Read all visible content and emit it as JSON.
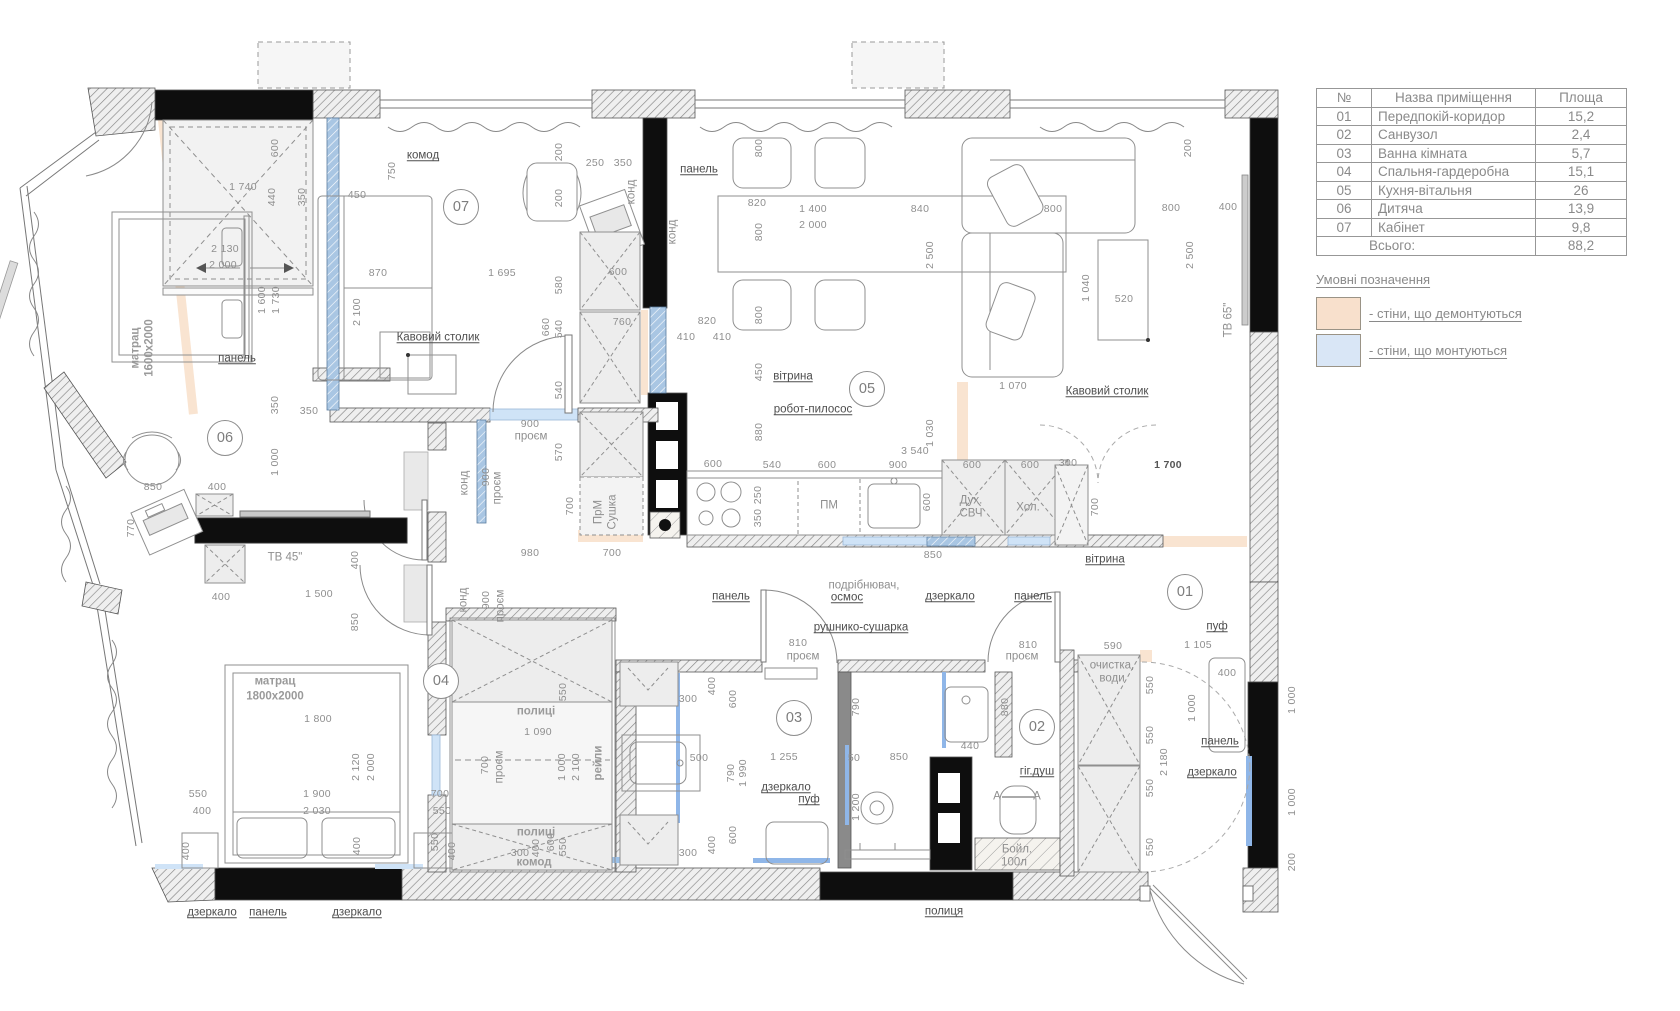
{
  "table": {
    "headers": [
      "№",
      "Назва приміщення",
      "Площа"
    ],
    "rows": [
      [
        "01",
        "Передпокій-коридор",
        "15,2"
      ],
      [
        "02",
        "Санвузол",
        "2,4"
      ],
      [
        "03",
        "Ванна кімната",
        "5,7"
      ],
      [
        "04",
        "Спальня-гардеробна",
        "15,1"
      ],
      [
        "05",
        "Кухня-вітальня",
        "26"
      ],
      [
        "06",
        "Дитяча",
        "13,9"
      ],
      [
        "07",
        "Кабінет",
        "9,8"
      ]
    ],
    "total_label": "Всього:",
    "total_value": "88,2"
  },
  "legend": {
    "title": "Умовні позначення",
    "items": [
      {
        "color": "#f8e0cc",
        "label": "- стіни, що демонтуються"
      },
      {
        "color": "#d9e6f6",
        "label": "- стіни, що монтуються"
      }
    ]
  },
  "colors": {
    "demolish": "#f8dfc9",
    "mount_blue": "#aac7e4",
    "light_blue": "#cfe3f7"
  },
  "plan": {
    "rooms": [
      {
        "num": "01",
        "x": 1185,
        "y": 592
      },
      {
        "num": "02",
        "x": 1037,
        "y": 727
      },
      {
        "num": "03",
        "x": 794,
        "y": 718
      },
      {
        "num": "04",
        "x": 441,
        "y": 681
      },
      {
        "num": "05",
        "x": 867,
        "y": 389
      },
      {
        "num": "06",
        "x": 225,
        "y": 438
      },
      {
        "num": "07",
        "x": 461,
        "y": 207
      }
    ],
    "labels": [
      {
        "t": "комод",
        "x": 423,
        "y": 156,
        "u": 1
      },
      {
        "t": "панель",
        "x": 699,
        "y": 170,
        "u": 1
      },
      {
        "t": "Кавовий столик",
        "x": 438,
        "y": 338,
        "u": 1
      },
      {
        "t": "панель",
        "x": 237,
        "y": 359,
        "u": 1
      },
      {
        "t": "вітрина",
        "x": 793,
        "y": 377,
        "u": 1
      },
      {
        "t": "робот-пилосос",
        "x": 813,
        "y": 410,
        "u": 1
      },
      {
        "t": "Кавовий столик",
        "x": 1107,
        "y": 392,
        "u": 1
      },
      {
        "t": "панель",
        "x": 731,
        "y": 597,
        "u": 1
      },
      {
        "t": "подрібнювач,",
        "x": 864,
        "y": 586
      },
      {
        "t": "осмос",
        "x": 847,
        "y": 598,
        "u": 1
      },
      {
        "t": "дзеркало",
        "x": 950,
        "y": 597,
        "u": 1
      },
      {
        "t": "панель",
        "x": 1033,
        "y": 597,
        "u": 1
      },
      {
        "t": "рушнико-сушарка",
        "x": 861,
        "y": 628,
        "u": 1
      },
      {
        "t": "вітрина",
        "x": 1105,
        "y": 560,
        "u": 1
      },
      {
        "t": "дзеркало",
        "x": 786,
        "y": 788,
        "u": 1
      },
      {
        "t": "пуф",
        "x": 809,
        "y": 800,
        "u": 1
      },
      {
        "t": "гіг.душ",
        "x": 1037,
        "y": 772,
        "u": 1
      },
      {
        "t": "Бойл.",
        "x": 1017,
        "y": 850
      },
      {
        "t": "100л",
        "x": 1014,
        "y": 863
      },
      {
        "t": "полиця",
        "x": 944,
        "y": 912,
        "u": 1
      },
      {
        "t": "дзеркало",
        "x": 212,
        "y": 913,
        "u": 1
      },
      {
        "t": "панель",
        "x": 268,
        "y": 913,
        "u": 1
      },
      {
        "t": "дзеркало",
        "x": 357,
        "y": 913,
        "u": 1
      },
      {
        "t": "пуф",
        "x": 1217,
        "y": 627,
        "u": 1
      },
      {
        "t": "панель",
        "x": 1220,
        "y": 742,
        "u": 1
      },
      {
        "t": "дзеркало",
        "x": 1212,
        "y": 773,
        "u": 1
      },
      {
        "t": "очистка,",
        "x": 1112,
        "y": 666
      },
      {
        "t": "води",
        "x": 1112,
        "y": 679
      },
      {
        "t": "ПМ",
        "x": 829,
        "y": 506
      },
      {
        "t": "Дух.",
        "x": 971,
        "y": 501
      },
      {
        "t": "СВЧ",
        "x": 971,
        "y": 514
      },
      {
        "t": "Хол.",
        "x": 1028,
        "y": 508
      },
      {
        "t": "ПрМ",
        "x": 599,
        "y": 512,
        "r": 1
      },
      {
        "t": "Сушка",
        "x": 613,
        "y": 512,
        "r": 1
      },
      {
        "t": "конд",
        "x": 632,
        "y": 192,
        "r": 1
      },
      {
        "t": "конд",
        "x": 673,
        "y": 232,
        "r": 1
      },
      {
        "t": "конд",
        "x": 465,
        "y": 483,
        "r": 1
      },
      {
        "t": "конд",
        "x": 464,
        "y": 600,
        "r": 1
      },
      {
        "t": "проєм",
        "x": 498,
        "y": 488,
        "r": 1
      },
      {
        "t": "проєм",
        "x": 501,
        "y": 606,
        "r": 1
      },
      {
        "t": "проєм",
        "x": 531,
        "y": 437
      },
      {
        "t": "проєм",
        "x": 803,
        "y": 657
      },
      {
        "t": "проєм",
        "x": 1022,
        "y": 657
      },
      {
        "t": "проєм",
        "x": 500,
        "y": 767,
        "r": 1
      },
      {
        "t": "матрац",
        "x": 136,
        "y": 348,
        "r": 1,
        "b": 1
      },
      {
        "t": "1600х2000",
        "x": 150,
        "y": 348,
        "r": 1,
        "b": 1
      },
      {
        "t": "матрац",
        "x": 275,
        "y": 682,
        "b": 1
      },
      {
        "t": "1800х2000",
        "x": 275,
        "y": 697,
        "b": 1
      },
      {
        "t": "ТВ 45\"",
        "x": 285,
        "y": 558
      },
      {
        "t": "ТВ 65\"",
        "x": 1229,
        "y": 320,
        "r": 1
      },
      {
        "t": "полиці",
        "x": 536,
        "y": 712,
        "b": 1
      },
      {
        "t": "полиці",
        "x": 536,
        "y": 833,
        "b": 1
      },
      {
        "t": "комод",
        "x": 534,
        "y": 863,
        "b": 1
      },
      {
        "t": "рейли",
        "x": 599,
        "y": 763,
        "r": 1,
        "b": 1
      },
      {
        "t": "A",
        "x": 997,
        "y": 797
      },
      {
        "t": "A",
        "x": 1037,
        "y": 797
      }
    ],
    "dims": [
      {
        "t": "600",
        "x": 275,
        "y": 148,
        "r": 1
      },
      {
        "t": "1 740",
        "x": 243,
        "y": 187
      },
      {
        "t": "440",
        "x": 272,
        "y": 197,
        "r": 1
      },
      {
        "t": "350",
        "x": 302,
        "y": 197,
        "r": 1
      },
      {
        "t": "450",
        "x": 357,
        "y": 195
      },
      {
        "t": "750",
        "x": 392,
        "y": 171,
        "r": 1
      },
      {
        "t": "2 130",
        "x": 225,
        "y": 249
      },
      {
        "t": "2 000",
        "x": 223,
        "y": 265
      },
      {
        "t": "1 600",
        "x": 262,
        "y": 300,
        "r": 1
      },
      {
        "t": "1 730",
        "x": 276,
        "y": 300,
        "r": 1
      },
      {
        "t": "870",
        "x": 378,
        "y": 273
      },
      {
        "t": "2 100",
        "x": 357,
        "y": 312,
        "r": 1
      },
      {
        "t": "350",
        "x": 275,
        "y": 405,
        "r": 1
      },
      {
        "t": "350",
        "x": 309,
        "y": 411
      },
      {
        "t": "1 000",
        "x": 275,
        "y": 462,
        "r": 1
      },
      {
        "t": "850",
        "x": 153,
        "y": 487
      },
      {
        "t": "400",
        "x": 217,
        "y": 487
      },
      {
        "t": "770",
        "x": 131,
        "y": 528,
        "r": 1
      },
      {
        "t": "400",
        "x": 355,
        "y": 560,
        "r": 1
      },
      {
        "t": "400",
        "x": 221,
        "y": 597
      },
      {
        "t": "1 500",
        "x": 319,
        "y": 594
      },
      {
        "t": "200",
        "x": 559,
        "y": 152,
        "r": 1
      },
      {
        "t": "250",
        "x": 595,
        "y": 163
      },
      {
        "t": "350",
        "x": 623,
        "y": 163
      },
      {
        "t": "200",
        "x": 559,
        "y": 198,
        "r": 1
      },
      {
        "t": "820",
        "x": 757,
        "y": 203
      },
      {
        "t": "1 400",
        "x": 813,
        "y": 209
      },
      {
        "t": "2 000",
        "x": 813,
        "y": 225
      },
      {
        "t": "800",
        "x": 759,
        "y": 148,
        "r": 1
      },
      {
        "t": "800",
        "x": 759,
        "y": 232,
        "r": 1
      },
      {
        "t": "800",
        "x": 759,
        "y": 315,
        "r": 1
      },
      {
        "t": "1 695",
        "x": 502,
        "y": 273
      },
      {
        "t": "580",
        "x": 559,
        "y": 285,
        "r": 1
      },
      {
        "t": "600",
        "x": 618,
        "y": 272
      },
      {
        "t": "660",
        "x": 546,
        "y": 327,
        "r": 1
      },
      {
        "t": "540",
        "x": 559,
        "y": 329,
        "r": 1
      },
      {
        "t": "760",
        "x": 622,
        "y": 322
      },
      {
        "t": "820",
        "x": 707,
        "y": 321
      },
      {
        "t": "410",
        "x": 686,
        "y": 337
      },
      {
        "t": "410",
        "x": 722,
        "y": 337
      },
      {
        "t": "450",
        "x": 759,
        "y": 372,
        "r": 1
      },
      {
        "t": "900",
        "x": 530,
        "y": 424
      },
      {
        "t": "540",
        "x": 559,
        "y": 390,
        "r": 1
      },
      {
        "t": "570",
        "x": 559,
        "y": 452,
        "r": 1
      },
      {
        "t": "700",
        "x": 570,
        "y": 506,
        "r": 1
      },
      {
        "t": "840",
        "x": 920,
        "y": 209
      },
      {
        "t": "2 500",
        "x": 930,
        "y": 255,
        "r": 1
      },
      {
        "t": "800",
        "x": 1053,
        "y": 209
      },
      {
        "t": "800",
        "x": 1171,
        "y": 208
      },
      {
        "t": "400",
        "x": 1228,
        "y": 207
      },
      {
        "t": "200",
        "x": 1188,
        "y": 148,
        "r": 1
      },
      {
        "t": "2 500",
        "x": 1190,
        "y": 255,
        "r": 1
      },
      {
        "t": "1 040",
        "x": 1086,
        "y": 288,
        "r": 1
      },
      {
        "t": "520",
        "x": 1124,
        "y": 299
      },
      {
        "t": "1 070",
        "x": 1013,
        "y": 386
      },
      {
        "t": "1 030",
        "x": 930,
        "y": 433,
        "r": 1
      },
      {
        "t": "3 540",
        "x": 915,
        "y": 451
      },
      {
        "t": "1 700",
        "x": 1168,
        "y": 465,
        "dark": 1
      },
      {
        "t": "600",
        "x": 713,
        "y": 464
      },
      {
        "t": "880",
        "x": 759,
        "y": 432,
        "r": 1
      },
      {
        "t": "540",
        "x": 772,
        "y": 465
      },
      {
        "t": "600",
        "x": 827,
        "y": 465
      },
      {
        "t": "900",
        "x": 898,
        "y": 465
      },
      {
        "t": "600",
        "x": 972,
        "y": 465
      },
      {
        "t": "600",
        "x": 1030,
        "y": 465
      },
      {
        "t": "300",
        "x": 1068,
        "y": 463
      },
      {
        "t": "250",
        "x": 758,
        "y": 495,
        "r": 1
      },
      {
        "t": "350",
        "x": 758,
        "y": 518,
        "r": 1
      },
      {
        "t": "600",
        "x": 927,
        "y": 502,
        "r": 1
      },
      {
        "t": "700",
        "x": 1095,
        "y": 507,
        "r": 1
      },
      {
        "t": "700",
        "x": 612,
        "y": 553
      },
      {
        "t": "980",
        "x": 530,
        "y": 553
      },
      {
        "t": "850",
        "x": 933,
        "y": 555
      },
      {
        "t": "900",
        "x": 486,
        "y": 477,
        "r": 1
      },
      {
        "t": "900",
        "x": 486,
        "y": 600,
        "r": 1
      },
      {
        "t": "700",
        "x": 485,
        "y": 765,
        "r": 1
      },
      {
        "t": "810",
        "x": 798,
        "y": 643
      },
      {
        "t": "810",
        "x": 1028,
        "y": 645
      },
      {
        "t": "850",
        "x": 355,
        "y": 622,
        "r": 1
      },
      {
        "t": "1 800",
        "x": 318,
        "y": 719
      },
      {
        "t": "2 120",
        "x": 356,
        "y": 767,
        "r": 1
      },
      {
        "t": "2 000",
        "x": 371,
        "y": 767,
        "r": 1
      },
      {
        "t": "550",
        "x": 198,
        "y": 794
      },
      {
        "t": "400",
        "x": 202,
        "y": 811
      },
      {
        "t": "1 900",
        "x": 317,
        "y": 794
      },
      {
        "t": "2 030",
        "x": 317,
        "y": 811
      },
      {
        "t": "700",
        "x": 440,
        "y": 794
      },
      {
        "t": "550",
        "x": 442,
        "y": 811
      },
      {
        "t": "400",
        "x": 186,
        "y": 851,
        "r": 1
      },
      {
        "t": "400",
        "x": 357,
        "y": 846,
        "r": 1
      },
      {
        "t": "400",
        "x": 452,
        "y": 851,
        "r": 1
      },
      {
        "t": "550",
        "x": 563,
        "y": 692,
        "r": 1
      },
      {
        "t": "1 090",
        "x": 538,
        "y": 732
      },
      {
        "t": "1 000",
        "x": 562,
        "y": 767,
        "r": 1
      },
      {
        "t": "2 100",
        "x": 576,
        "y": 767,
        "r": 1
      },
      {
        "t": "550",
        "x": 563,
        "y": 847,
        "r": 1
      },
      {
        "t": "550",
        "x": 435,
        "y": 842,
        "r": 1
      },
      {
        "t": "300",
        "x": 520,
        "y": 853
      },
      {
        "t": "400",
        "x": 536,
        "y": 848,
        "r": 1
      },
      {
        "t": "600",
        "x": 551,
        "y": 842,
        "r": 1
      },
      {
        "t": "300",
        "x": 688,
        "y": 699
      },
      {
        "t": "400",
        "x": 712,
        "y": 686,
        "r": 1
      },
      {
        "t": "600",
        "x": 733,
        "y": 699,
        "r": 1
      },
      {
        "t": "500",
        "x": 699,
        "y": 758
      },
      {
        "t": "790",
        "x": 731,
        "y": 773,
        "r": 1
      },
      {
        "t": "1 990",
        "x": 743,
        "y": 773,
        "r": 1
      },
      {
        "t": "1 255",
        "x": 784,
        "y": 757
      },
      {
        "t": "600",
        "x": 733,
        "y": 835,
        "r": 1
      },
      {
        "t": "400",
        "x": 712,
        "y": 845,
        "r": 1
      },
      {
        "t": "300",
        "x": 688,
        "y": 853
      },
      {
        "t": "790",
        "x": 856,
        "y": 707,
        "r": 1
      },
      {
        "t": "50",
        "x": 854,
        "y": 758
      },
      {
        "t": "850",
        "x": 899,
        "y": 757
      },
      {
        "t": "1 200",
        "x": 856,
        "y": 807,
        "r": 1
      },
      {
        "t": "440",
        "x": 970,
        "y": 746
      },
      {
        "t": "880",
        "x": 1005,
        "y": 707,
        "r": 1
      },
      {
        "t": "590",
        "x": 1113,
        "y": 646
      },
      {
        "t": "1 105",
        "x": 1198,
        "y": 645
      },
      {
        "t": "400",
        "x": 1227,
        "y": 673
      },
      {
        "t": "1 000",
        "x": 1192,
        "y": 708,
        "r": 1
      },
      {
        "t": "1 000",
        "x": 1292,
        "y": 700,
        "r": 1
      },
      {
        "t": "550",
        "x": 1150,
        "y": 685,
        "r": 1
      },
      {
        "t": "550",
        "x": 1150,
        "y": 735,
        "r": 1
      },
      {
        "t": "550",
        "x": 1150,
        "y": 788,
        "r": 1
      },
      {
        "t": "550",
        "x": 1150,
        "y": 847,
        "r": 1
      },
      {
        "t": "2 180",
        "x": 1164,
        "y": 762,
        "r": 1
      },
      {
        "t": "1 000",
        "x": 1292,
        "y": 802,
        "r": 1
      },
      {
        "t": "200",
        "x": 1292,
        "y": 862,
        "r": 1
      }
    ]
  }
}
